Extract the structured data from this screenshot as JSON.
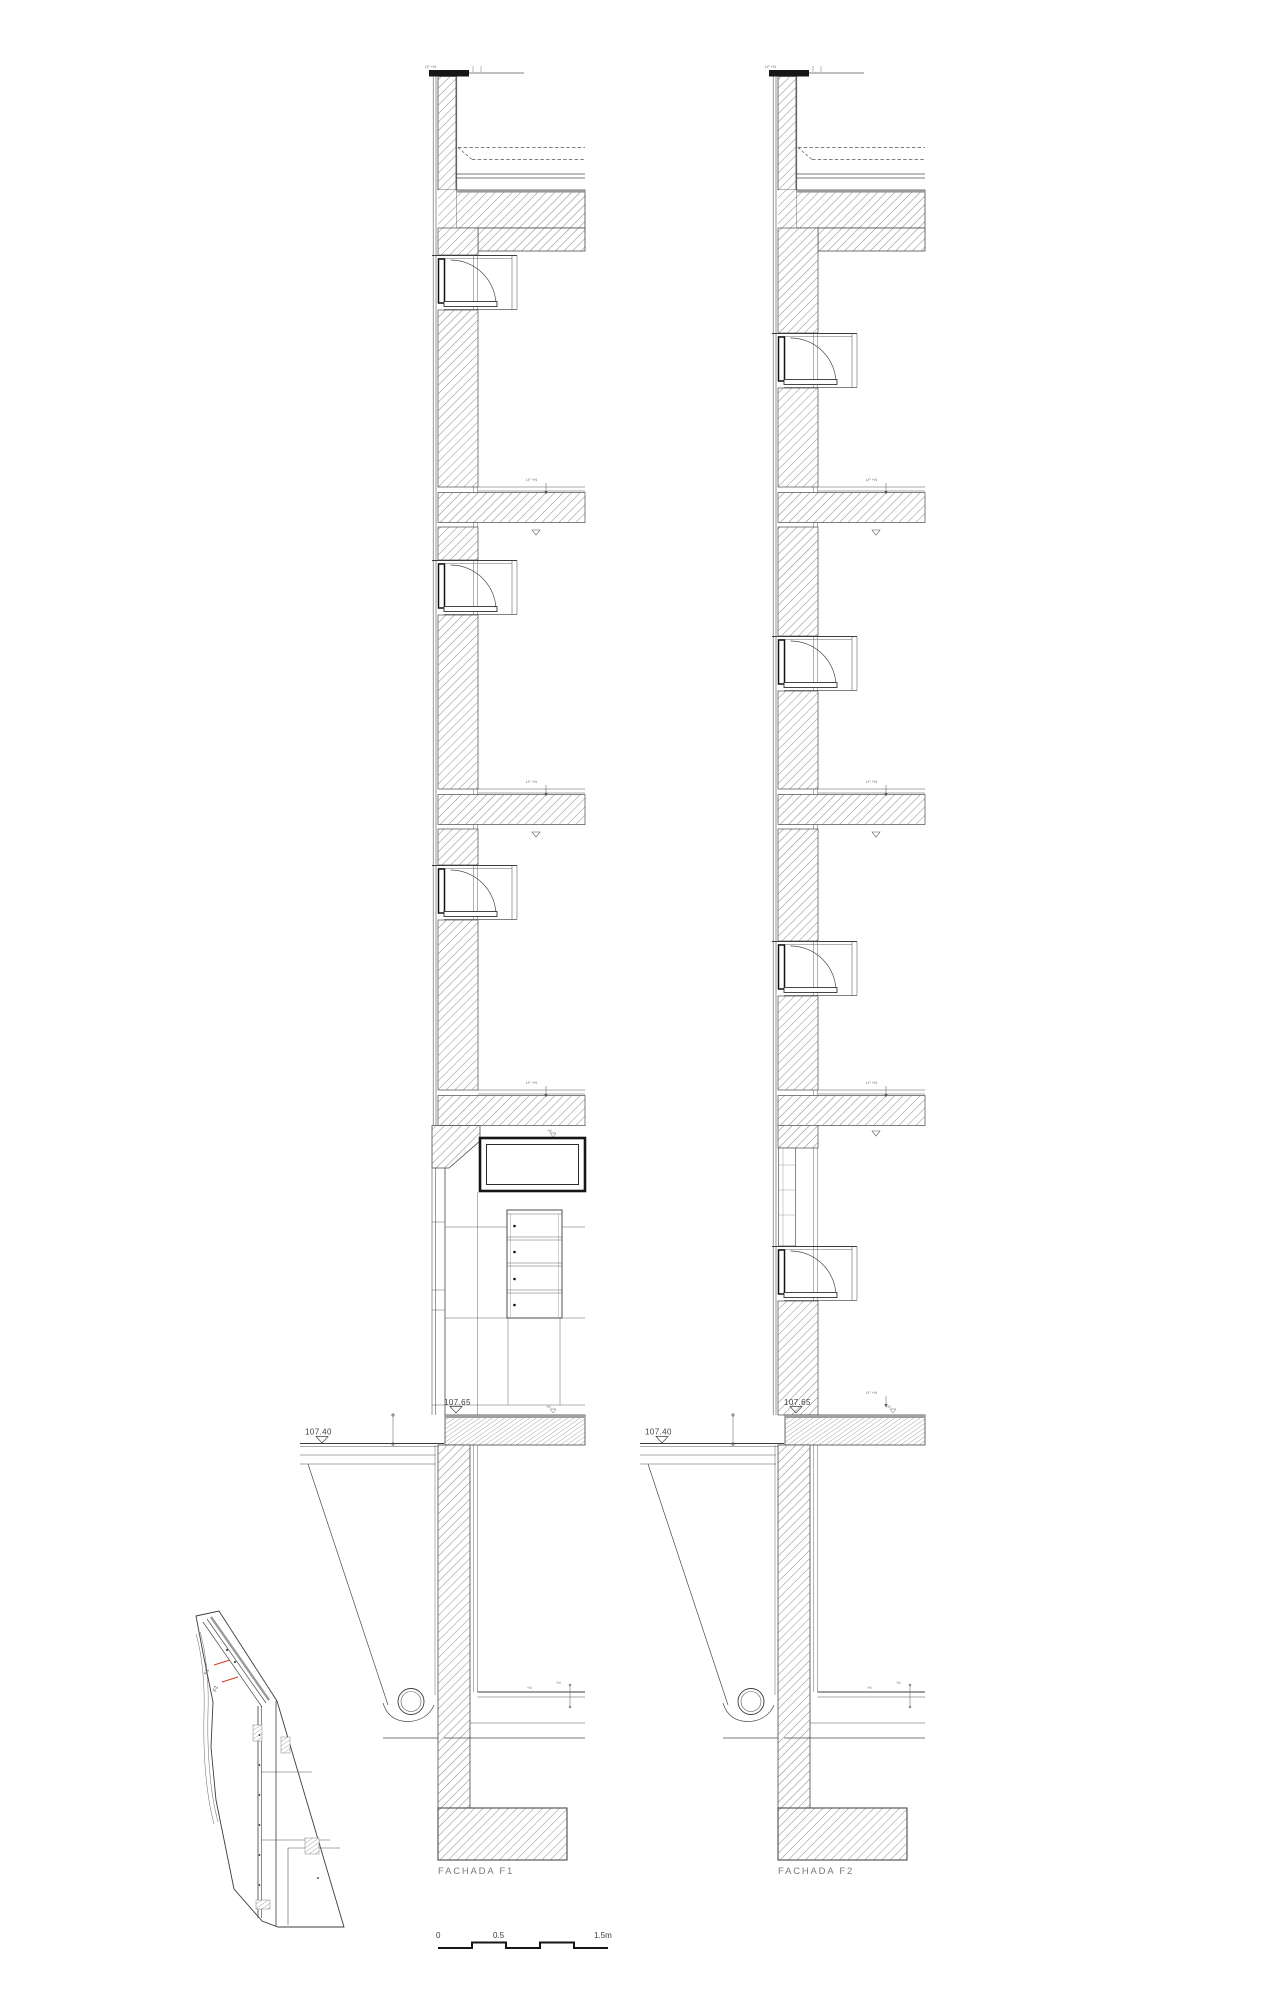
{
  "sections": [
    {
      "label": "FACHADA F1"
    },
    {
      "label": "FACHADA F2"
    }
  ],
  "levels": {
    "exterior": "107.40",
    "ground": "107.65"
  },
  "annotations": {
    "parapet_tag": "LF +N",
    "slab_tag": "LF +N",
    "small_tag": "+N"
  },
  "scale_bar": {
    "zero": "0",
    "half": "0.5",
    "end": "1.5m"
  },
  "key_plan": {
    "cut_f1": "F1",
    "cut_f2": "F2",
    "accent": "#d43b2a"
  },
  "colors": {
    "line": "#3c3c3c",
    "dark": "#161616",
    "hatch": "#7d7d7d",
    "label": "#7a7a7a"
  }
}
